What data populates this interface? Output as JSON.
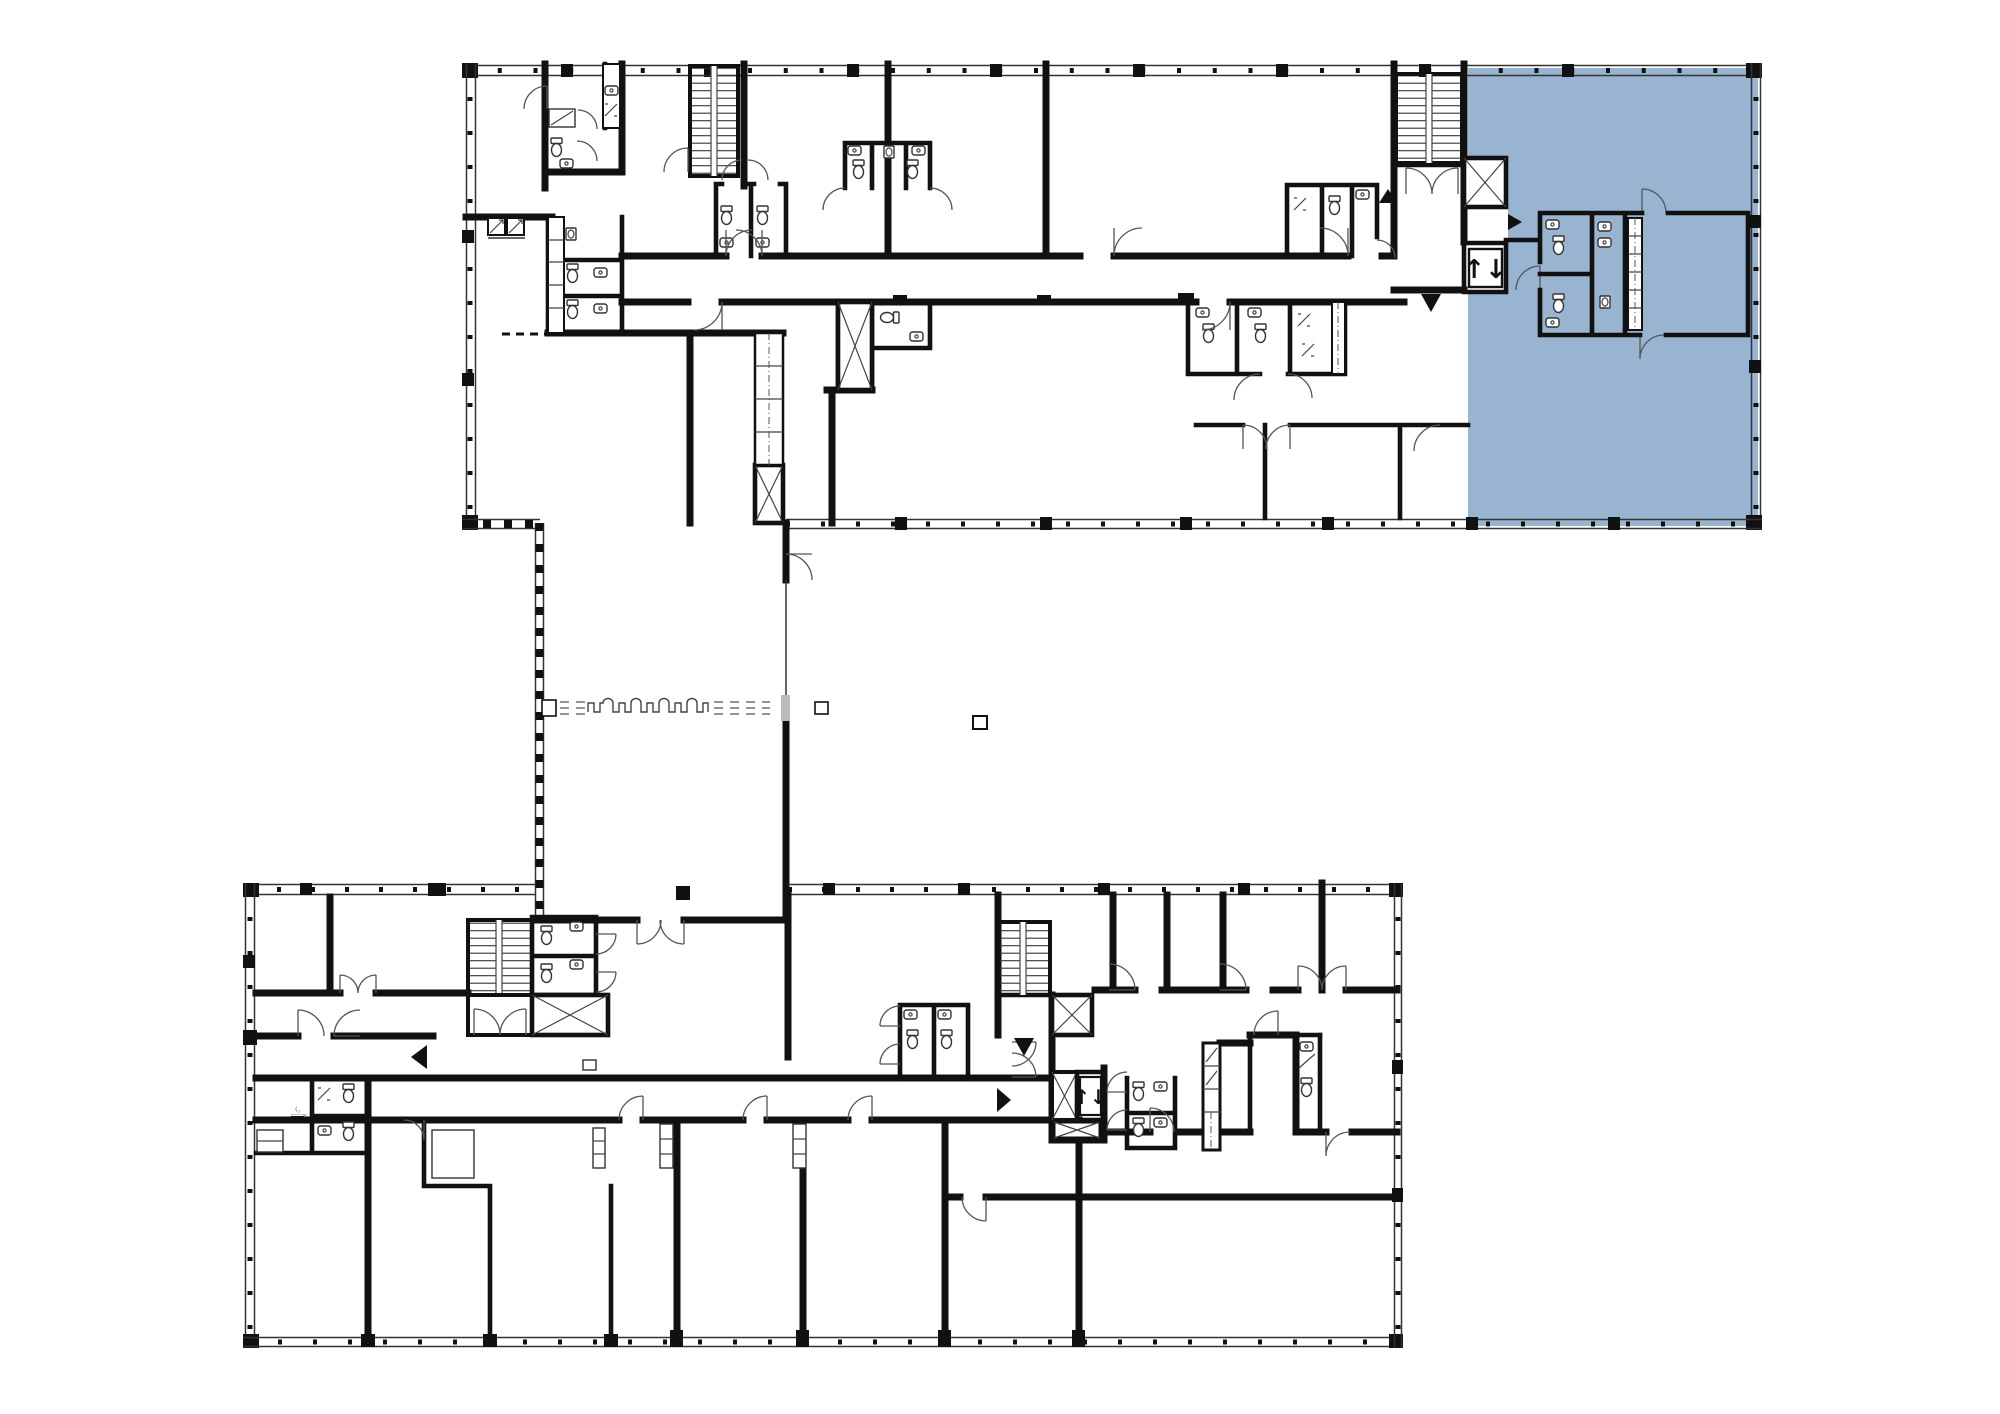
{
  "app": {
    "title": "Office floor plan",
    "kind": "architectural-floor-plan",
    "floors_shown": 1
  },
  "colors": {
    "background": "#ffffff",
    "walls": "#111111",
    "thin_lines": "#444444",
    "highlight": "#98b4d0",
    "door_leaf": "#bbbbbb"
  },
  "icons": {
    "elevator_glyph": "↑↓",
    "coffee_glyph": "☕",
    "elevator_name": "elevator-up-down-icon",
    "stairs_name": "stairs-icon",
    "shaft_name": "shaft-cross-icon",
    "entrance_marker_name": "entrance-triangle-icon"
  },
  "highlighted_unit": {
    "label": "Selected unit",
    "wing": "north-wing-east",
    "fill": "#98b4d0",
    "selected": true
  },
  "markers": {
    "up": "▲",
    "down": "▼",
    "left": "◀",
    "right": "▶"
  }
}
